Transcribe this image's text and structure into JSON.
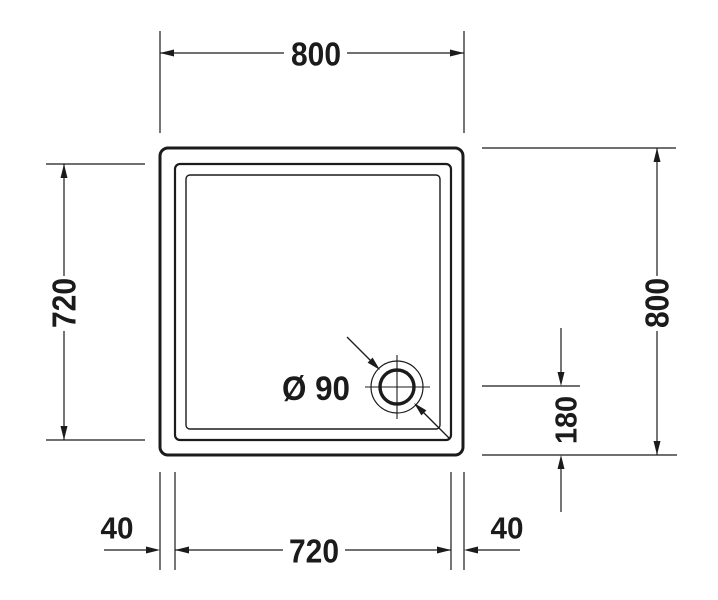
{
  "drawing": {
    "line_color": "#1b1b1b",
    "background_color": "#ffffff",
    "dimensions": {
      "top_width": "800",
      "left_inner_height": "720",
      "right_height": "800",
      "drain_offset_from_bottom": "180",
      "bottom_inner_width": "720",
      "bottom_left_rim": "40",
      "bottom_right_rim": "40"
    },
    "drain": {
      "diameter_label": "Ø 90"
    }
  }
}
